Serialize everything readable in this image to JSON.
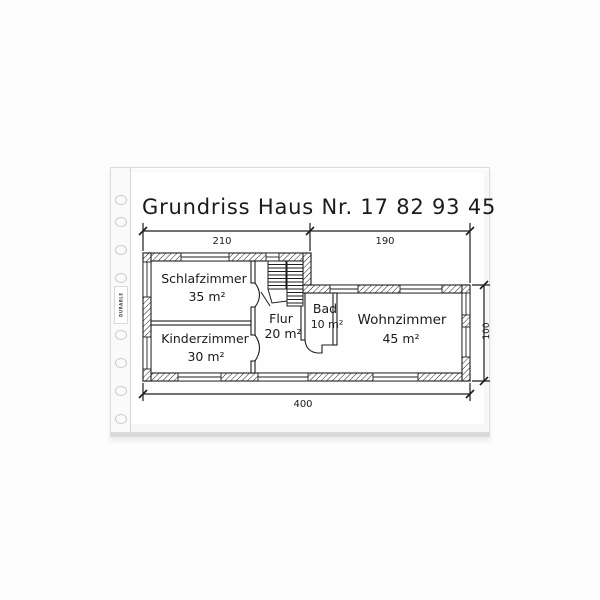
{
  "sleeve": {
    "brand": "DURABLE"
  },
  "drawing": {
    "title": "Grundriss Haus Nr. 17 82 93 45",
    "rooms": [
      {
        "name": "Schlafzimmer",
        "area": "35 m²"
      },
      {
        "name": "Kinderzimmer",
        "area": "30 m²"
      },
      {
        "name": "Flur",
        "area": "20 m²"
      },
      {
        "name": "Bad",
        "area": "10 m²"
      },
      {
        "name": "Wohnzimmer",
        "area": "45 m²"
      }
    ],
    "dimensions": {
      "top_left": "210",
      "top_right": "190",
      "bottom": "400",
      "right": "100"
    },
    "colors": {
      "ink": "#1d1d1d",
      "paper": "#ffffff"
    }
  }
}
